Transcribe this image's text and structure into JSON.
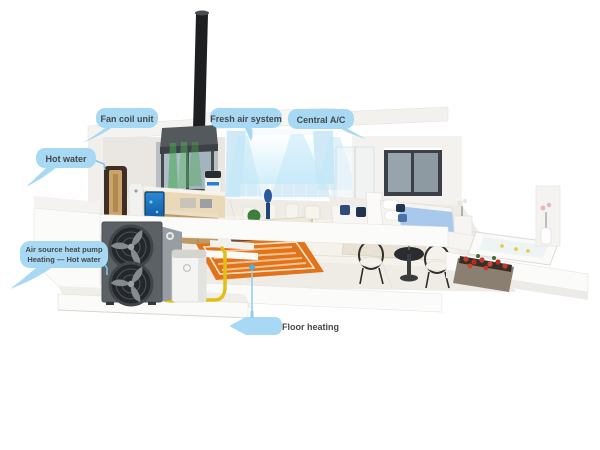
{
  "illustration": {
    "kind": "3d-cutaway-home-heat-pump-system",
    "objects": [
      "outdoor-heat-pump-unit",
      "water-tank",
      "yellow-pipe",
      "floor-heating-coil",
      "hot-water-cabinet",
      "aquarium",
      "kitchen-island",
      "fresh-air-ceiling-unit",
      "roof-duct",
      "dining-set",
      "sofa",
      "bed",
      "lounge-chairs",
      "outdoor-bathtub",
      "flower-planter",
      "curtains",
      "air-cones"
    ]
  },
  "callouts": {
    "fan_coil": {
      "label": "Fan coil unit"
    },
    "fresh_air": {
      "label": "Fresh air system"
    },
    "central_ac": {
      "label": "Central A/C"
    },
    "hot_water": {
      "label": "Hot water"
    },
    "heat_pump": {
      "label_line1": "Air source heat pump",
      "label_line2": "Heating — Hot water"
    },
    "floor_heating": {
      "label": "Floor heating"
    }
  },
  "colors": {
    "background": "#ffffff",
    "callout_bubble": "#a7d9f4",
    "callout_text": "#474747",
    "leader_line": "#7fc4ea",
    "marker_dot": "#49b0e8",
    "pipe_yellow": "#e2bf17",
    "floor_heating_orange": "#e2731d",
    "airflow_blue": "#bfe6f8",
    "airflow_green": "#44a94f",
    "outdoor_unit_gray": "#5c6165"
  }
}
